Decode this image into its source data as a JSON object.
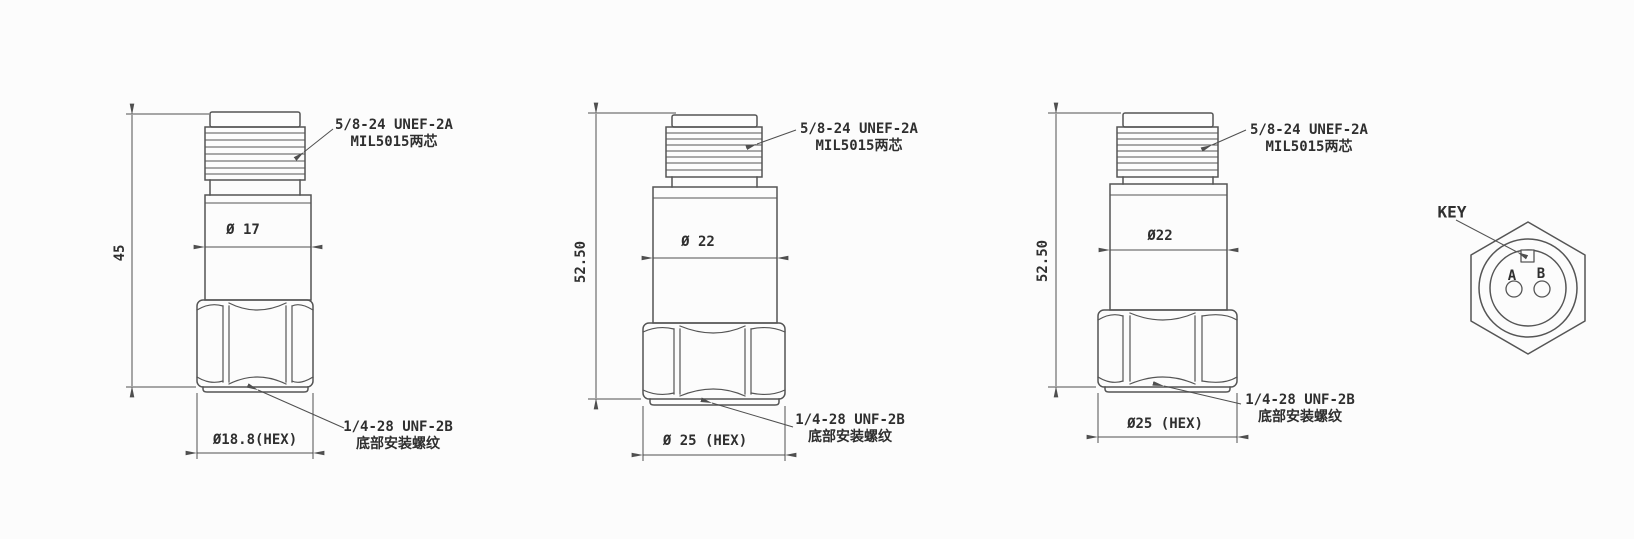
{
  "canvas": {
    "background": "#fcfcfc",
    "line_color": "#555555",
    "text_color": "#2f2f2f"
  },
  "drawings": [
    {
      "overall_height": "45",
      "body_diameter": "Ø 17",
      "hex_width": "Ø18.8(HEX)",
      "connector_note": {
        "line1": "5/8-24 UNEF-2A",
        "line2": "MIL5015两芯"
      },
      "mount_note": {
        "line1": "1/4-28 UNF-2B",
        "line2": "底部安装螺纹"
      }
    },
    {
      "overall_height": "52.50",
      "body_diameter": "Ø 22",
      "hex_width": "Ø 25 (HEX)",
      "connector_note": {
        "line1": "5/8-24 UNEF-2A",
        "line2": "MIL5015两芯"
      },
      "mount_note": {
        "line1": "1/4-28 UNF-2B",
        "line2": "底部安装螺纹"
      }
    },
    {
      "overall_height": "52.50",
      "body_diameter": "Ø22",
      "hex_width": "Ø25 (HEX)",
      "connector_note": {
        "line1": "5/8-24 UNEF-2A",
        "line2": "MIL5015两芯"
      },
      "mount_note": {
        "line1": "1/4-28 UNF-2B",
        "line2": "底部安装螺纹"
      }
    }
  ],
  "connector_face": {
    "label": "KEY",
    "pin_a": "A",
    "pin_b": "B"
  }
}
